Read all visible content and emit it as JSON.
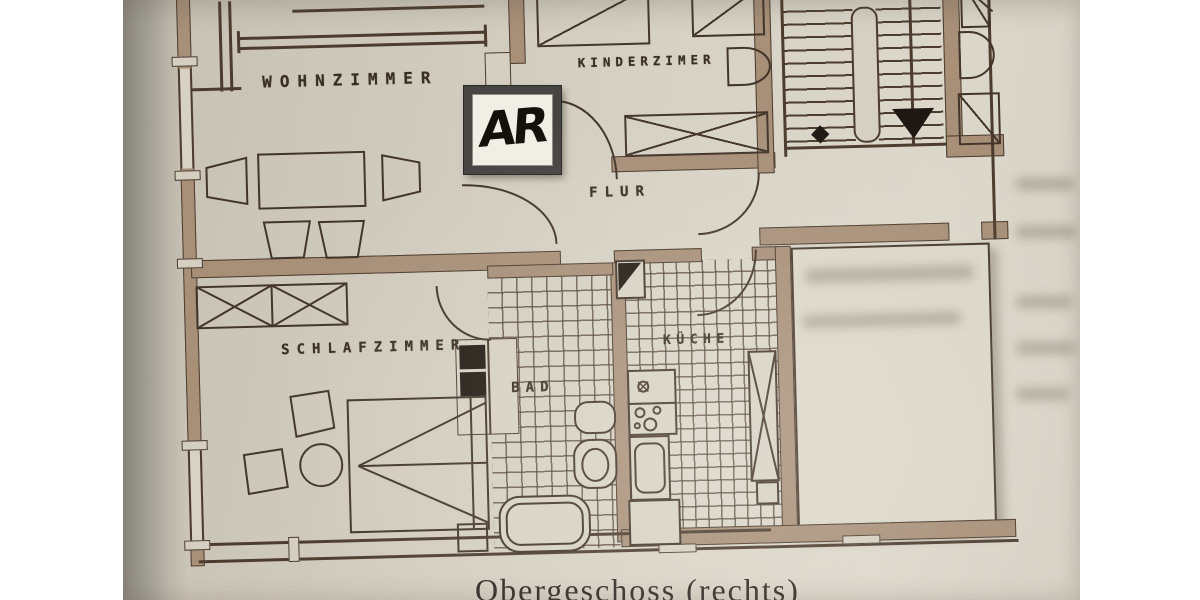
{
  "labels": {
    "wohnzimmer": "WOHNZIMMER",
    "kinderzimmer": "KINDERZIMER",
    "flur": "FLUR",
    "schlafzimmer": "SCHLAFZIMMER",
    "bad": "BAD",
    "kueche": "KÜCHE"
  },
  "annotation": {
    "label": "AR"
  },
  "caption": {
    "text": "Obergeschoss (rechts)"
  },
  "colors": {
    "background": "#ffffff",
    "paper": "#d7d2c5",
    "ink": "#43352a",
    "wall_fill": "#a78f78",
    "fixture_black": "#1f1812",
    "annotation_frame": "#474543",
    "annotation_bg": "#f1eee6",
    "photo_edge": "#8e8b83"
  }
}
